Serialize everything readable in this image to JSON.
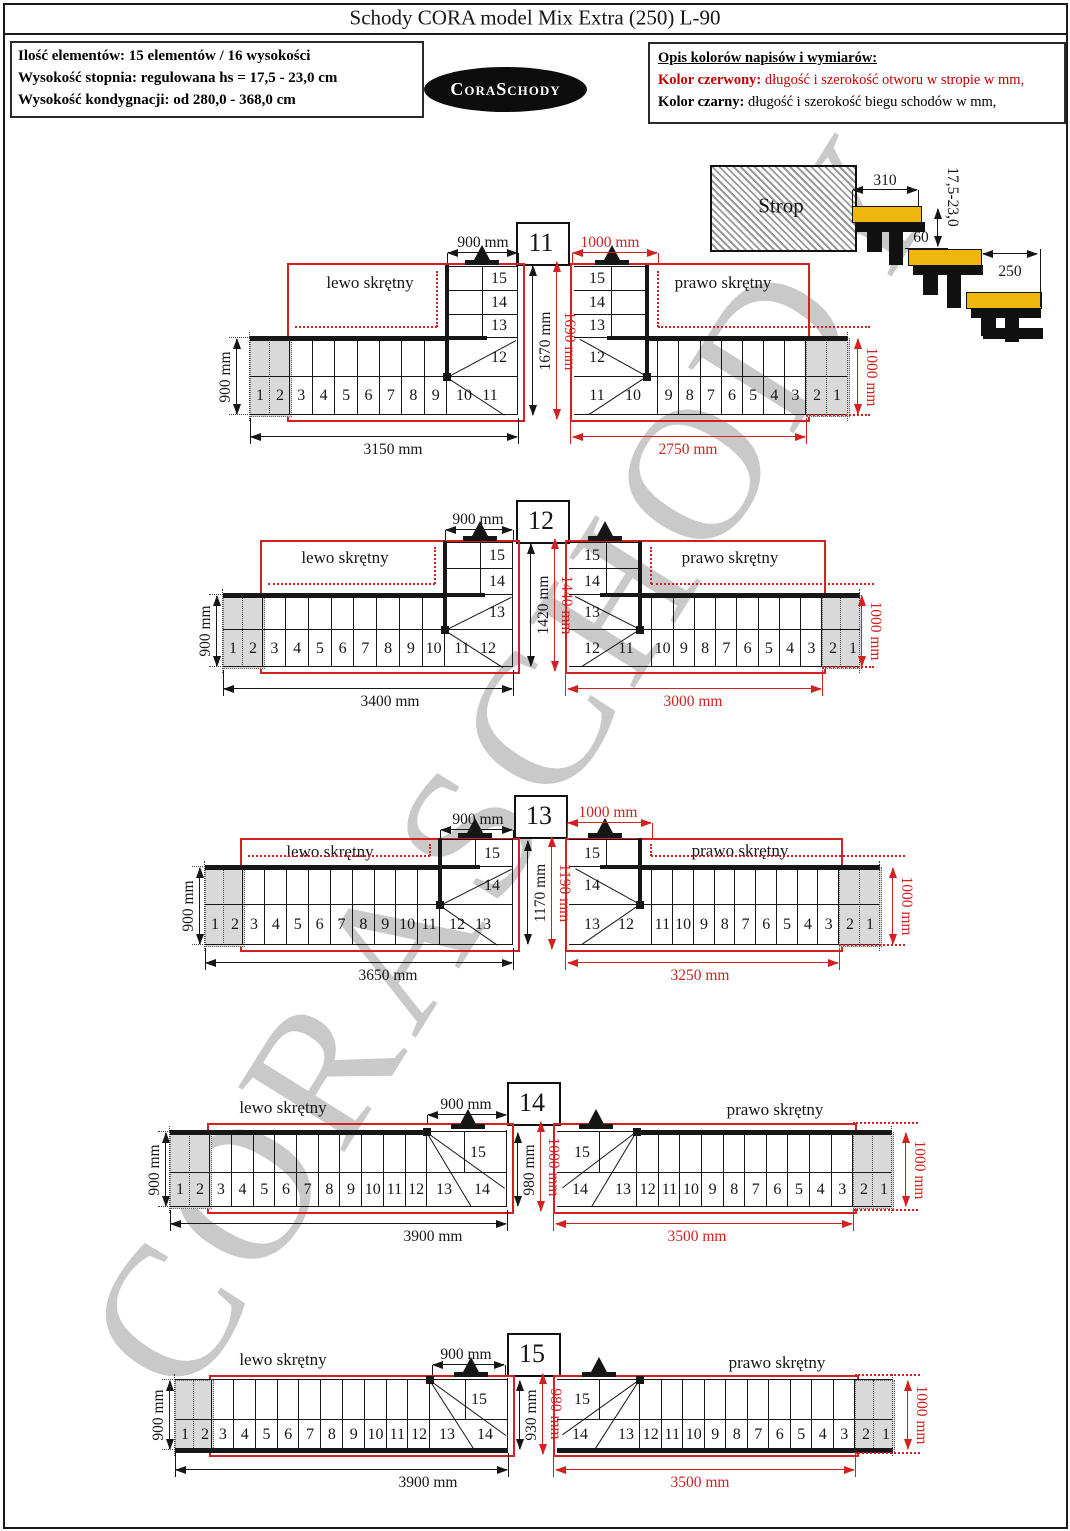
{
  "title": "Schody CORA model Mix Extra (250) L-90",
  "info_box": {
    "lines": [
      "Ilość elementów: 15 elementów / 16 wysokości",
      "Wysokość stopnia: regulowana  hs = 17,5 - 23,0 cm",
      "Wysokość kondygnacji: od 280,0 - 368,0 cm"
    ]
  },
  "logo": {
    "text": "CoraSchody"
  },
  "legend": {
    "heading": "Opis kolorów napisów i wymiarów:",
    "red_prefix": "Kolor czerwony:",
    "red_text": " długość i szerokość otworu w stropie w mm,",
    "black_prefix": "Kolor czarny:",
    "black_text": " długość i szerokość biegu schodów w mm,"
  },
  "section": {
    "label": "Strop",
    "tread_depth": "310",
    "rise_range": "17,5-23,0",
    "nosing": "60",
    "tread_width": "250"
  },
  "watermark": "CORASCHODY",
  "colors": {
    "red": "#d32121",
    "black": "#161616",
    "yellow": "#efb70d",
    "gray_step": "#d9d9d9"
  },
  "variants": [
    {
      "id": "11",
      "left": {
        "label": "lewo skrętny",
        "dims": {
          "top": "900 mm",
          "side": "900 mm",
          "length": "3150 mm",
          "depth": "1670 mm"
        },
        "steps": {
          "gray": [
            "1",
            "2"
          ],
          "straight": [
            "3",
            "4",
            "5",
            "6",
            "7",
            "8",
            "9"
          ],
          "fan": "10",
          "corner": "11",
          "strip": "12",
          "stacked": [
            "15",
            "14",
            "13"
          ]
        }
      },
      "right": {
        "label": "prawo skrętny",
        "dims": {
          "top": "1000 mm",
          "side": "1000 mm",
          "length": "2750 mm",
          "depth": "1690 mm"
        },
        "steps": {
          "gray": [
            "2",
            "1"
          ],
          "straight": [
            "9",
            "8",
            "7",
            "6",
            "5",
            "4",
            "3"
          ],
          "fan": "10",
          "corner": "11",
          "strip": "12",
          "stacked": [
            "15",
            "14",
            "13"
          ]
        }
      }
    },
    {
      "id": "12",
      "left": {
        "label": "lewo skrętny",
        "dims": {
          "top": "900 mm",
          "side": "900 mm",
          "length": "3400 mm",
          "depth": "1420 mm"
        },
        "steps": {
          "gray": [
            "1",
            "2"
          ],
          "straight": [
            "3",
            "4",
            "5",
            "6",
            "7",
            "8",
            "9",
            "10"
          ],
          "fan": "11",
          "corner": "12",
          "strip": "13",
          "stacked": [
            "15",
            "14"
          ]
        }
      },
      "right": {
        "label": "prawo skrętny",
        "dims": {
          "side": "1000 mm",
          "length": "3000 mm",
          "depth": "1440 mm"
        },
        "steps": {
          "gray": [
            "2",
            "1"
          ],
          "straight": [
            "10",
            "9",
            "8",
            "7",
            "6",
            "5",
            "4",
            "3"
          ],
          "fan": "11",
          "corner": "12",
          "strip": "13",
          "stacked": [
            "15",
            "14"
          ]
        }
      }
    },
    {
      "id": "13",
      "left": {
        "label": "lewo skrętny",
        "dims": {
          "top": "900 mm",
          "side": "900 mm",
          "length": "3650 mm",
          "depth": "1170 mm"
        },
        "steps": {
          "gray": [
            "1",
            "2"
          ],
          "straight": [
            "3",
            "4",
            "5",
            "6",
            "7",
            "8",
            "9",
            "10",
            "11"
          ],
          "fan": "12",
          "corner": "13",
          "strip": "14",
          "stacked": [
            "15"
          ]
        }
      },
      "right": {
        "label": "prawo skrętny",
        "dims": {
          "top": "1000 mm",
          "side": "1000 mm",
          "length": "3250 mm",
          "depth": "1190 mm"
        },
        "steps": {
          "gray": [
            "2",
            "1"
          ],
          "straight": [
            "11",
            "10",
            "9",
            "8",
            "7",
            "6",
            "5",
            "4",
            "3"
          ],
          "fan": "12",
          "corner": "13",
          "strip": "14",
          "stacked": [
            "15"
          ]
        }
      }
    },
    {
      "id": "14",
      "left": {
        "label": "lewo skrętny",
        "dims": {
          "top": "900 mm",
          "side": "900 mm",
          "length": "3900 mm",
          "depth": "980 mm"
        },
        "steps": {
          "gray": [
            "1",
            "2"
          ],
          "straight": [
            "3",
            "4",
            "5",
            "6",
            "7",
            "8",
            "9",
            "10",
            "11",
            "12"
          ],
          "fan": "13",
          "corner": "14",
          "strip": "15",
          "stacked": []
        }
      },
      "right": {
        "label": "prawo skrętny",
        "dims": {
          "side": "1000 mm",
          "length": "3500 mm",
          "depth": "1000 mm"
        },
        "steps": {
          "gray": [
            "2",
            "1"
          ],
          "straight": [
            "12",
            "11",
            "10",
            "9",
            "8",
            "7",
            "6",
            "5",
            "4",
            "3"
          ],
          "fan": "13",
          "corner": "14",
          "strip": "15",
          "stacked": []
        }
      }
    },
    {
      "id": "15",
      "left": {
        "label": "lewo skrętny",
        "dims": {
          "top": "900 mm",
          "side": "900 mm",
          "length": "3900 mm",
          "depth": "930 mm"
        },
        "steps": {
          "gray": [
            "1",
            "2"
          ],
          "straight": [
            "3",
            "4",
            "5",
            "6",
            "7",
            "8",
            "9",
            "10",
            "11",
            "12"
          ],
          "fan": "13",
          "corner": "14",
          "strip": "15",
          "stacked": []
        }
      },
      "right": {
        "label": "prawo skrętny",
        "dims": {
          "side": "1000 mm",
          "length": "3500 mm",
          "depth": "980 mm"
        },
        "steps": {
          "gray": [
            "2",
            "1"
          ],
          "straight": [
            "12",
            "11",
            "10",
            "9",
            "8",
            "7",
            "6",
            "5",
            "4",
            "3"
          ],
          "fan": "13",
          "corner": "14",
          "strip": "15",
          "stacked": []
        }
      }
    }
  ]
}
